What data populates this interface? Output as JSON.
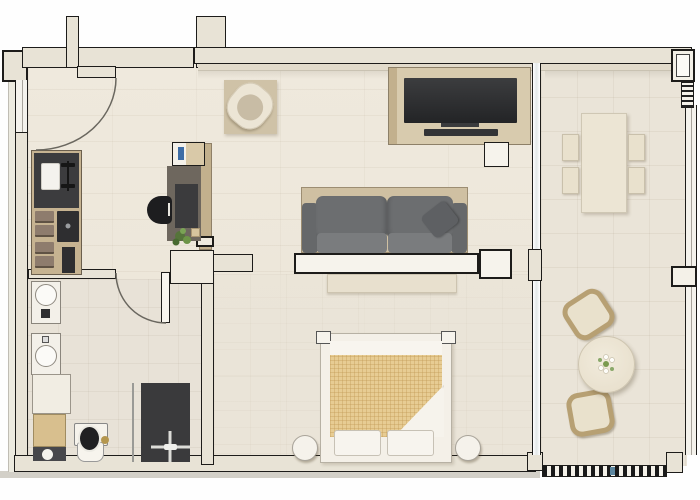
{
  "meta": {
    "title": "Apartment floor plan - top-down 3D render",
    "type": "floor-plan",
    "view": "top-down"
  },
  "colors": {
    "wall_fill": "#e8e3d6",
    "wall_outline": "#1d1c1a",
    "floor_main": "#efe9dd",
    "bath_floor": "#e8e2d7",
    "terrace_floor": "#eae4d8",
    "sill": "#e2dbcb",
    "glass": "#e3e8e9",
    "slab_shadow": "#d3d0c8",
    "wood": "#cfc0a2",
    "wood_dark": "#c2b08d",
    "console_wood": "#d8cbae",
    "counter_dark": "#3c3c3e",
    "appliance_dark": "#2e2e30",
    "drawer_brown": "#8e7c6d",
    "desk_top": "#6e675e",
    "desk_pad": "#3b3b3d",
    "chair_black": "#1d1d1f",
    "sofa_gray": "#6c6e70",
    "sofa_seat": "#7a7c7e",
    "sofa_arm": "#66686a",
    "pillow_gray": "#5e6063",
    "tv_screen": "#232426",
    "white_furniture": "#f6f3ec",
    "furn_outline": "#b7b1a4",
    "blanket_tan": "#e7cc93",
    "blanket_line": "#d4b273",
    "rug": "#cfc2a7",
    "sand": "#d8bf8e",
    "gold": "#b5974f",
    "plant_green": "#5d8038",
    "blue_accent": "#3e6da6",
    "glass_blue": "#5d87a0",
    "rattan": "#b7a073"
  },
  "rooms": [
    {
      "id": "entry-hall",
      "label": "Entry hall"
    },
    {
      "id": "home-office",
      "label": "Home office nook"
    },
    {
      "id": "kitchen",
      "label": "Kitchenette"
    },
    {
      "id": "bathroom",
      "label": "Bathroom and laundry"
    },
    {
      "id": "living-room",
      "label": "Living room"
    },
    {
      "id": "bedroom",
      "label": "Bedroom"
    },
    {
      "id": "terrace",
      "label": "Terrace"
    }
  ],
  "furniture": {
    "entry_hall": [
      "entrance-door",
      "door-swing-arc"
    ],
    "home_office": [
      "wall-cabinet",
      "desk",
      "desk-pad",
      "office-chair",
      "potted-plant",
      "divider-panel"
    ],
    "kitchen": [
      "dark-countertop",
      "sink",
      "faucet",
      "drawer-stack-4",
      "oven",
      "tall-appliance"
    ],
    "bathroom": [
      "washing-machine",
      "dryer",
      "storage-cabinet",
      "vanity-unit",
      "toilet",
      "walk-in-shower",
      "shower-glass",
      "bathroom-door"
    ],
    "living_room": [
      "armchair",
      "area-rug",
      "tv-console",
      "tv",
      "media-shelf",
      "stool",
      "sofa",
      "throw-pillow",
      "console-wall",
      "side-block",
      "low-dresser"
    ],
    "bedroom": [
      "double-bed",
      "checkered-duvet",
      "folded-blanket",
      "pillow-pair",
      "round-nightstand-left",
      "round-nightstand-right"
    ],
    "terrace": [
      "dining-table",
      "dining-chairs-4",
      "round-coffee-table",
      "flower-centerpiece",
      "lounge-stool-top",
      "lounge-stool-bottom",
      "glass-partition",
      "railing",
      "pillar-top",
      "pillar-mid",
      "vent-hatch"
    ]
  }
}
